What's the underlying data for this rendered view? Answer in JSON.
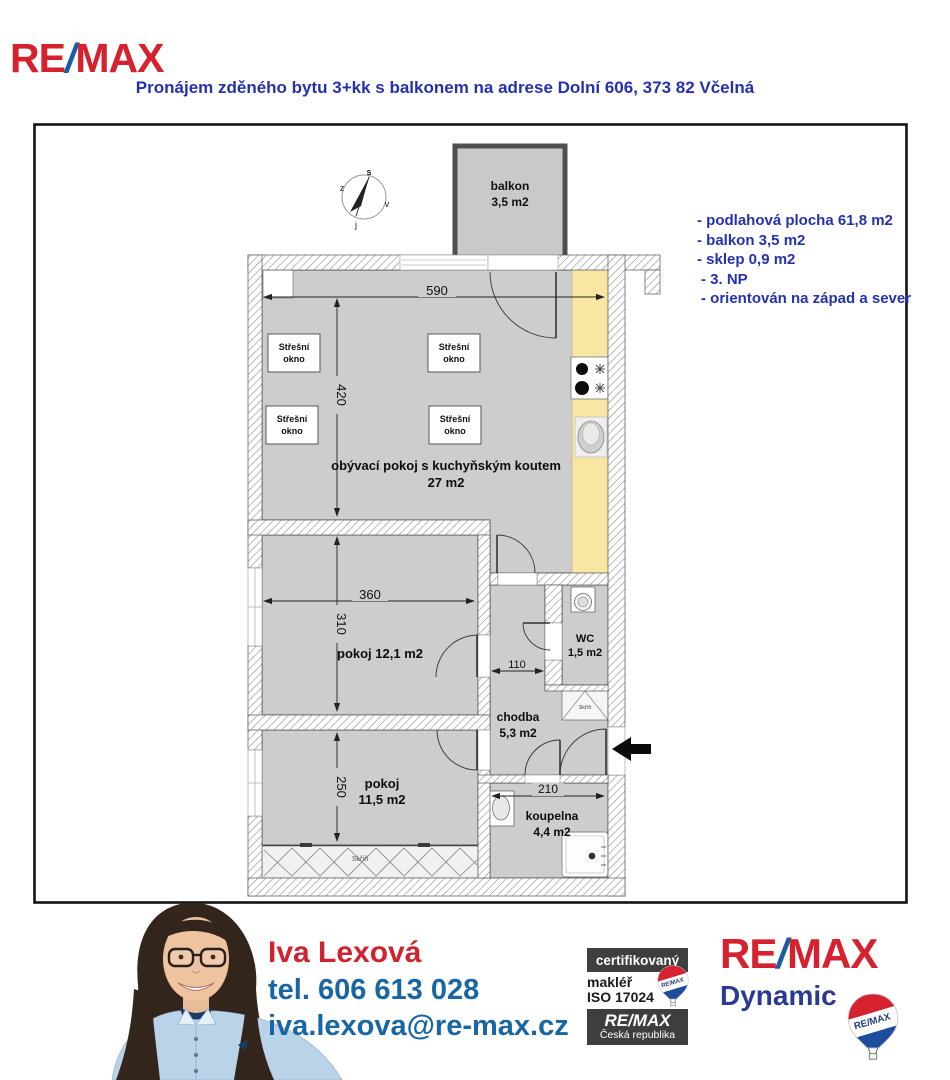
{
  "header": {
    "brand": {
      "re": "RE",
      "slash": "/",
      "max": "MAX"
    },
    "title": "Pronájem zděného bytu 3+kk s balkonem na adrese Dolní 606, 373 82 Včelná"
  },
  "info": {
    "line1": "- podlahová plocha 61,8 m2",
    "line2": "- balkon 3,5 m2",
    "line3": "- sklep 0,9 m2",
    "line4": "- 3. NP",
    "line5": "- orientován na západ a sever"
  },
  "plan": {
    "compass": {
      "north": "s",
      "west": "z",
      "east": "v",
      "south": "j"
    },
    "balkon": {
      "name": "balkon",
      "area": "3,5 m2"
    },
    "living": {
      "name": "obývací pokoj s kuchyňským koutem",
      "area": "27 m2"
    },
    "room1": {
      "name": "pokoj 12,1 m2"
    },
    "room2": {
      "name": "pokoj",
      "area": "11,5 m2"
    },
    "wc": {
      "name": "WC",
      "area": "1,5 m2"
    },
    "chodba": {
      "name": "chodba",
      "area": "5,3 m2"
    },
    "koupelna": {
      "name": "koupelna",
      "area": "4,4 m2"
    },
    "skylight": {
      "line1": "Střešní",
      "line2": "okno"
    },
    "wardrobe": {
      "label": "Skříň",
      "label2": "Skříň"
    },
    "dims": {
      "living_w": "590",
      "living_h": "420",
      "room1_w": "360",
      "room1_h": "310",
      "room2_h": "250",
      "chodba_w": "110",
      "koupelna_w": "210"
    }
  },
  "agent": {
    "name": "Iva Lexová",
    "phone": "tel. 606 613 028",
    "email": "iva.lexova@re-max.cz"
  },
  "badges": {
    "certified": "certifikovaný",
    "broker": "makléř",
    "iso": "ISO 17024",
    "brand": "RE/MAX",
    "country": "Česká republika",
    "balloon": "RE/MAX"
  },
  "office": {
    "re": "RE",
    "slash": "/",
    "max": "MAX",
    "name": "Dynamic",
    "balloon": "RE/MAX"
  },
  "colors": {
    "remax_red": "#d6212f",
    "remax_blue": "#1c5ba6",
    "title_blue": "#2531ae",
    "contact_blue": "#1966a6",
    "dynamic_blue": "#2b3a90",
    "room_gray": "#cdcdcd",
    "kitchen_yellow": "#f8e6a2"
  }
}
